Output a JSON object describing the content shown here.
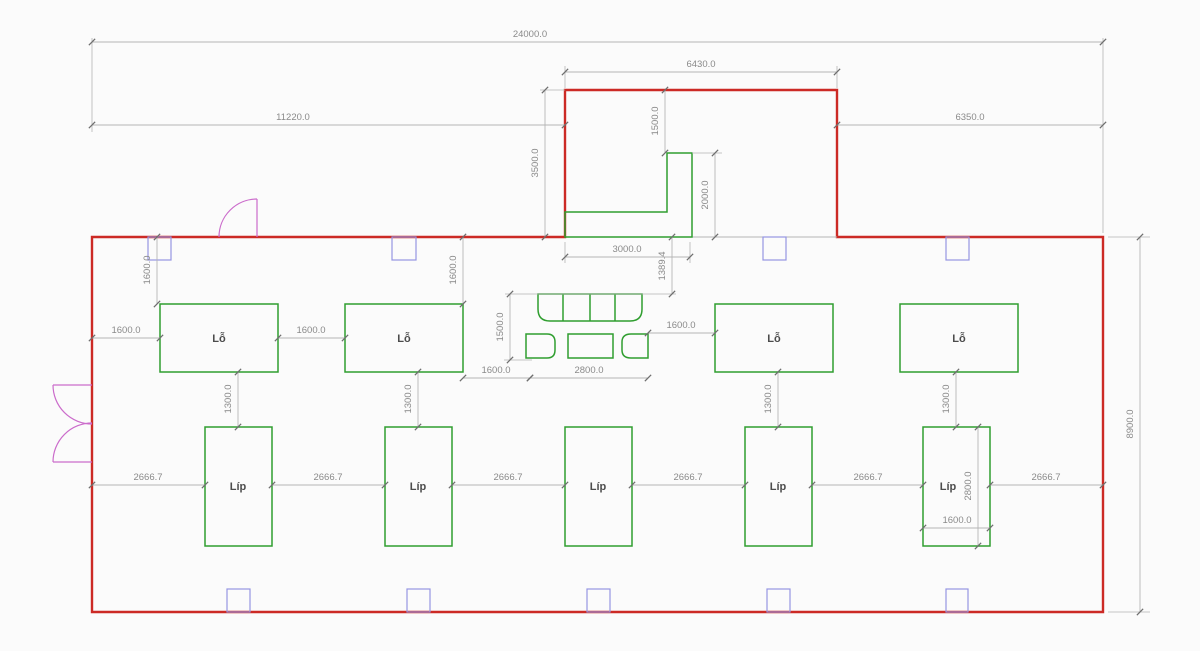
{
  "plan": {
    "labels": {
      "room_top": "Lỗ",
      "room_bottom": "Líp"
    },
    "dims": {
      "v24000": "24000.0",
      "v11220": "11220.0",
      "v6430": "6430.0",
      "v6350": "6350.0",
      "v8900": "8900.0",
      "v3500": "3500.0",
      "v1500": "1500.0",
      "v2000": "2000.0",
      "v3000": "3000.0",
      "v1389": "1389.4",
      "v1600": "1600.0",
      "v1300": "1300.0",
      "v2666": "2666.7",
      "v2800": "2800.0"
    },
    "colors": {
      "background": "#fbfbfb",
      "wall": "#cc2a25",
      "fixture": "#2f9e2f",
      "column": "#9595e2",
      "door": "#cb6ccb",
      "dim_line": "#b5b5b5",
      "dim_tick": "#6e6e6e",
      "dim_text": "#8a8a8a",
      "label_text": "#4c4c4c"
    }
  }
}
